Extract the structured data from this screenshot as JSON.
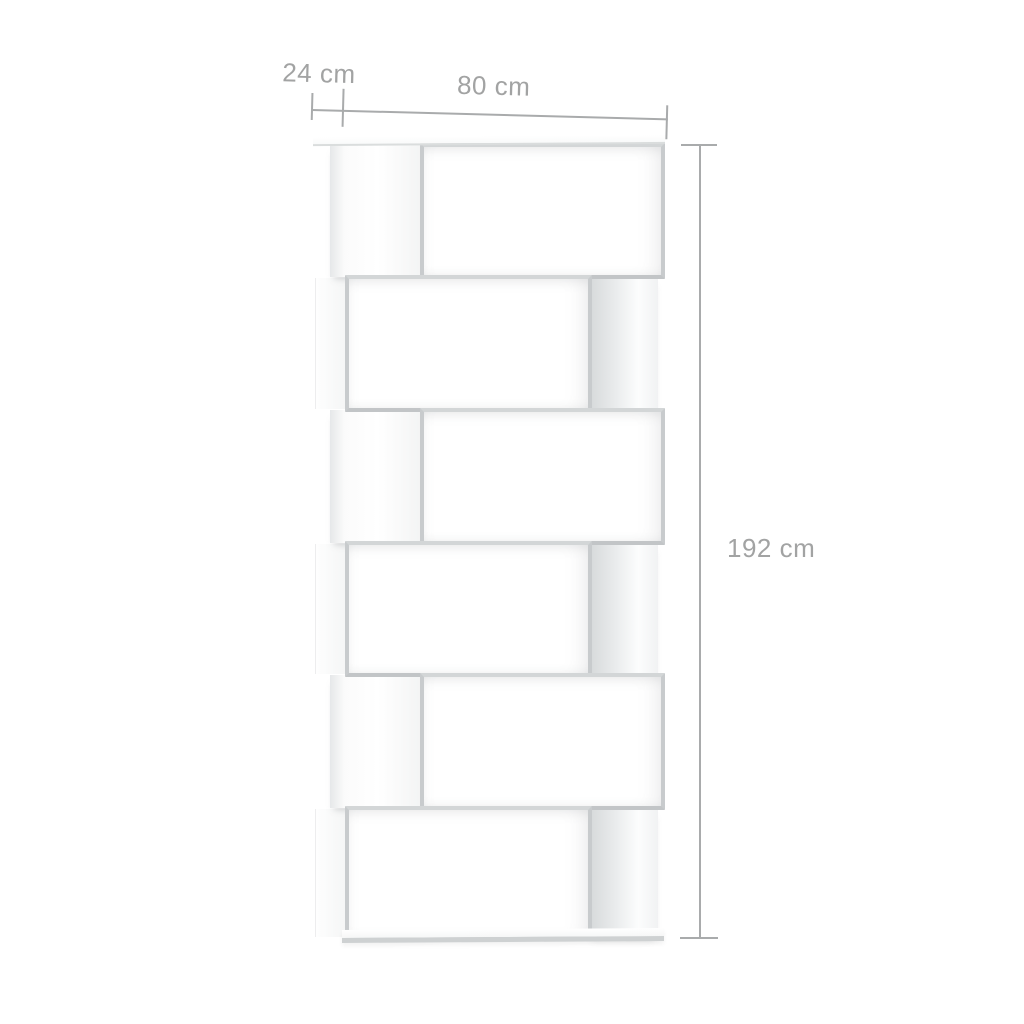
{
  "figure": {
    "type": "furniture-dimension-diagram",
    "background": "plain white"
  },
  "product": {
    "name": "zig-zag bookcase room divider",
    "finish": "white",
    "tier_count": 6,
    "tiers": [
      {
        "row": 1,
        "layout": "panel-left"
      },
      {
        "row": 2,
        "layout": "panel-right"
      },
      {
        "row": 3,
        "layout": "panel-left"
      },
      {
        "row": 4,
        "layout": "panel-right"
      },
      {
        "row": 5,
        "layout": "panel-left"
      },
      {
        "row": 6,
        "layout": "panel-right"
      }
    ]
  },
  "dimensions": {
    "depth": {
      "label": "24 cm",
      "value_cm": 24
    },
    "width": {
      "label": "80 cm",
      "value_cm": 80
    },
    "height": {
      "label": "192 cm",
      "value_cm": 192
    }
  },
  "style": {
    "background_color": "#ffffff",
    "annotation_text_color": "#a2a3a3",
    "dimension_line_color": "#a9abac",
    "shelf_frame_color": "#c8cbcd",
    "shelf_surface_color": "#ffffff"
  }
}
